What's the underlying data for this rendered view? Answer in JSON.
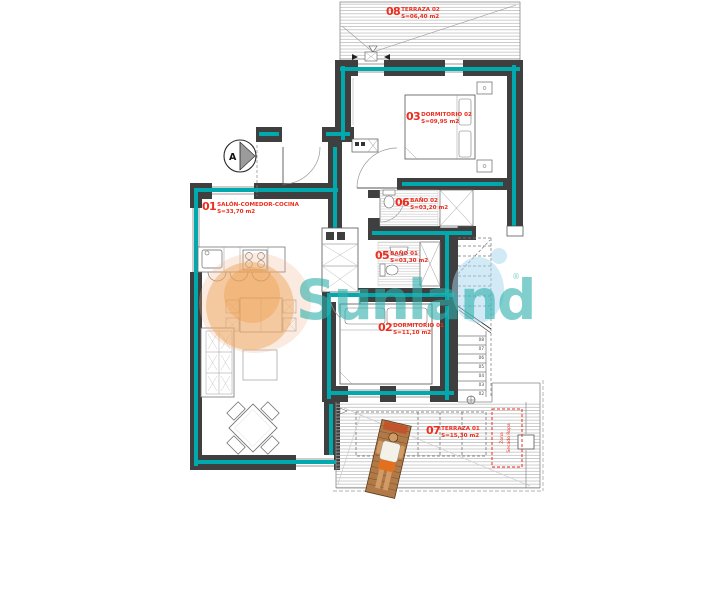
{
  "watermark": {
    "brand": "Sunland",
    "registered": "®"
  },
  "section_marker": "A",
  "rooms": [
    {
      "id": "01",
      "name": "SALÓN-COMEDOR-COCINA",
      "area": "S=33,70 m2"
    },
    {
      "id": "02",
      "name": "DORMITORIO 01",
      "area": "S=11,10 m2"
    },
    {
      "id": "03",
      "name": "DORMITORIO 02",
      "area": "S=09,95 m2"
    },
    {
      "id": "05",
      "name": "BAÑO 01",
      "area": "S=03,30 m2"
    },
    {
      "id": "06",
      "name": "BAÑO 02",
      "area": "S=03,20 m2"
    },
    {
      "id": "07",
      "name": "TERRAZA 01",
      "area": "S=15,30 m2"
    },
    {
      "id": "08",
      "name": "TERRAZA 02",
      "area": "S=06,40 m2"
    }
  ],
  "drying_zone": {
    "line1": "Zona",
    "line2": "Secado Ropa"
  },
  "stairs_steps": [
    "08",
    "07",
    "06",
    "05",
    "04",
    "03",
    "02"
  ],
  "colors": {
    "label_red": "#ee2b1c",
    "wall_dark": "#3f3f3f",
    "insulation_teal": "#00a9ad",
    "brand_teal": "#2fb0ad",
    "brand_orange": "#f0a860",
    "brand_blue": "#a3d6ee"
  }
}
